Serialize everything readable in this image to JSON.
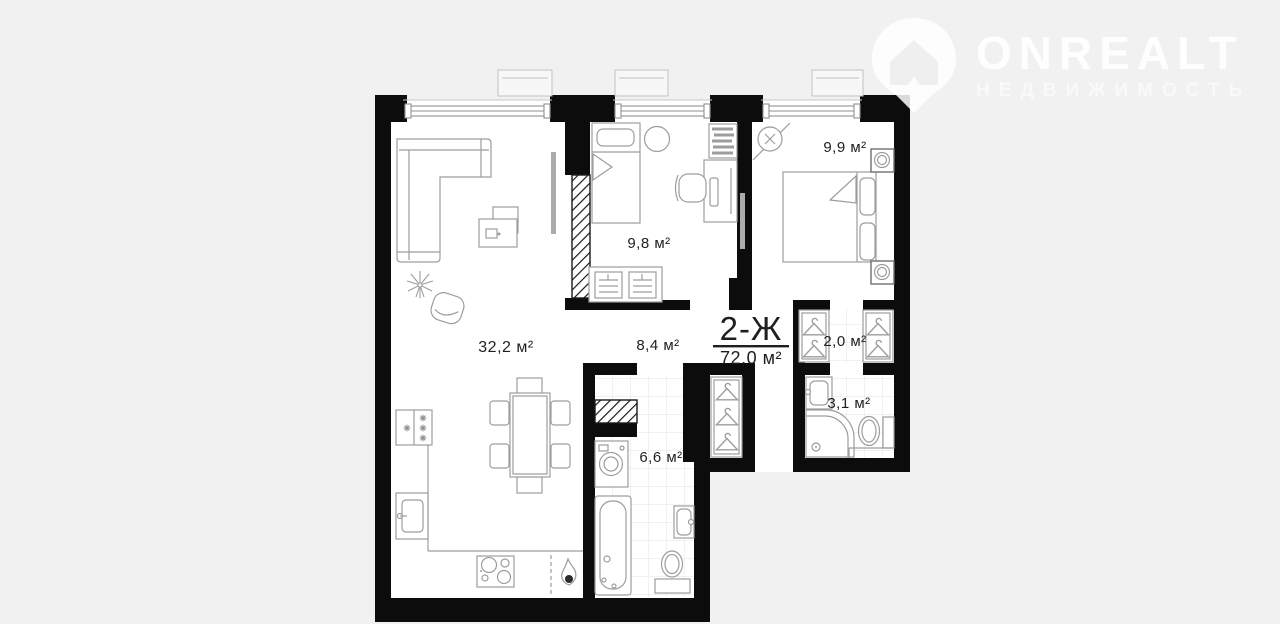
{
  "canvas": {
    "background": "#f1f1f2"
  },
  "logo": {
    "brand": "ONREALT",
    "tagline": "НЕДВИЖИМОСТЬ",
    "icon": "map-pin-house-icon",
    "color": "#ffffff"
  },
  "plan": {
    "unit_label": "2-Ж",
    "total_area": "72,0 м²",
    "colors": {
      "walls": "#0c0c0c",
      "floor": "#ffffff",
      "furniture_line": "#9d9d9d",
      "text": "#1f1f1f",
      "tile_line": "#e3e3e3",
      "window_line": "#8f8f8f"
    },
    "rooms": [
      {
        "name": "living-room-kitchen",
        "area": "32,2 м²"
      },
      {
        "name": "bedroom",
        "area": "9,8 м²"
      },
      {
        "name": "master-bedroom",
        "area": "9,9 м²"
      },
      {
        "name": "hallway",
        "area": "8,4 м²"
      },
      {
        "name": "bathroom",
        "area": "6,6 м²"
      },
      {
        "name": "walk-in-closet",
        "area": "2,0 м²"
      },
      {
        "name": "master-bathroom",
        "area": "3,1 м²"
      }
    ]
  }
}
